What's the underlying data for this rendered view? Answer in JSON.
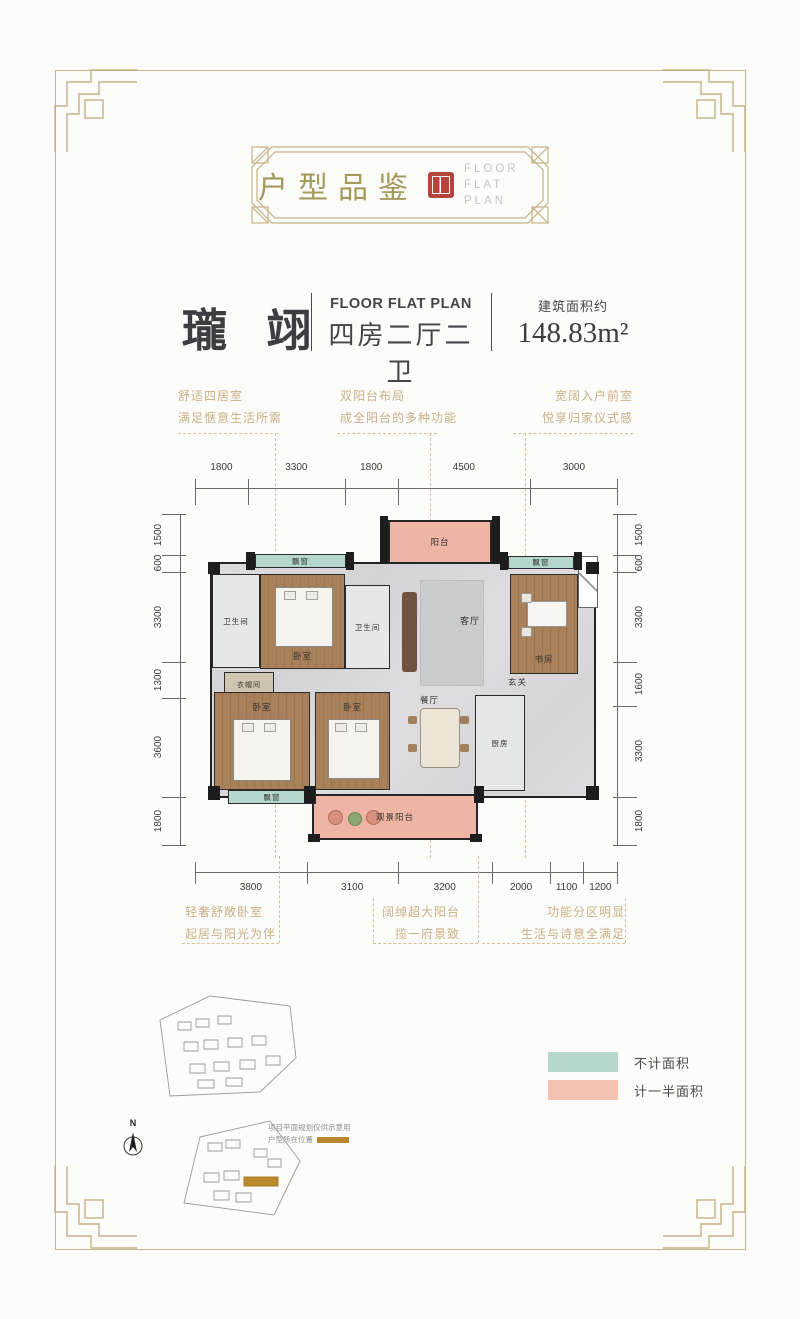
{
  "badge": {
    "title": "户型品鉴",
    "en_line1": "FLOOR FLAT",
    "en_line2": "PLAN"
  },
  "title": {
    "name": "瓏 翊",
    "en": "FLOOR FLAT PLAN",
    "layout": "四房二厅二卫",
    "area_label": "建筑面积约",
    "area_value": "148.83m²"
  },
  "annotations_top": [
    {
      "line1": "舒适四居室",
      "line2": "满足惬意生活所需"
    },
    {
      "line1": "双阳台布局",
      "line2": "成全阳台的多种功能"
    },
    {
      "line1": "宽阔入户前室",
      "line2": "悦享归家仪式感"
    }
  ],
  "annotations_bottom": [
    {
      "line1": "轻奢舒敞卧室",
      "line2": "起居与阳光为伴"
    },
    {
      "line1": "阔绰超大阳台",
      "line2": "揽一府景致"
    },
    {
      "line1": "功能分区明显",
      "line2": "生活与诗意全满足"
    }
  ],
  "dimensions": {
    "top": [
      1800,
      3300,
      1800,
      4500,
      3000
    ],
    "bottom": [
      3800,
      3100,
      3200,
      2000,
      1100,
      1200
    ],
    "left": [
      1500,
      600,
      3300,
      1300,
      3600,
      1800
    ],
    "right": [
      1500,
      600,
      3300,
      1600,
      3300,
      1800
    ]
  },
  "rooms": {
    "balcony_top": "阳台",
    "bay_top_left": "飘窗",
    "bay_top_right": "飘窗",
    "bay_bottom_left": "飘窗",
    "bath_left": "卫生间",
    "bath_mid": "卫生间",
    "bedroom_top_left": "卧室",
    "bedroom_bottom_left": "卧室",
    "bedroom_bottom_mid": "卧室",
    "study": "书房",
    "living": "客厅",
    "dining": "餐厅",
    "kitchen": "厨房",
    "entry": "玄关",
    "cloakroom": "衣帽间",
    "balcony_bottom": "观景阳台"
  },
  "legend": [
    {
      "label": "不计面积",
      "color": "#b7d7cd"
    },
    {
      "label": "计一半面积",
      "color": "#f4c2ae"
    }
  ],
  "site": {
    "note_line1": "项目平面规划仅供示意用",
    "note_line2": "户型所在位置",
    "north_label": "N"
  },
  "colors": {
    "frame_gold": "#c6b287",
    "annotation_gold": "#c8b086",
    "seal_red": "#b5443c",
    "teal": "#b7d7cd",
    "pink": "#f0b6a5"
  }
}
